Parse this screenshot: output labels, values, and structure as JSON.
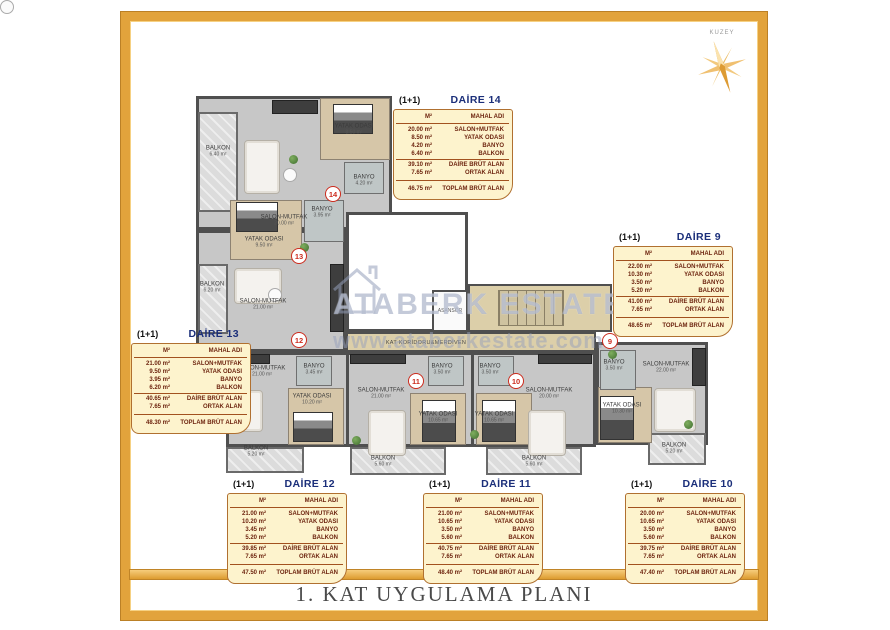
{
  "page": {
    "title": "1. KAT UYGULAMA PLANI"
  },
  "compass": {
    "label": "KUZEY"
  },
  "watermark": {
    "text": "ATABERK ESTATE",
    "url": "www.ataberkestate.com"
  },
  "colors": {
    "frame_gold": "#e2a33c",
    "table_bg": "#fdf3cd",
    "table_border": "#b07030",
    "table_text": "#6e2510",
    "unit_name_navy": "#1b2f7a",
    "badge_red": "#cc2b1d",
    "corridor_beige": "#dccfa9",
    "watermark_blue": "#949eba"
  },
  "tables": [
    {
      "type": "(1+1)",
      "name": "DAİRE 14",
      "col_area": "M²",
      "col_room": "MAHAL ADI",
      "rows": [
        [
          "20.00 m²",
          "SALON+MUTFAK"
        ],
        [
          "8.50 m²",
          "YATAK ODASI"
        ],
        [
          "4.20 m²",
          "BANYO"
        ],
        [
          "6.40 m²",
          "BALKON"
        ]
      ],
      "sub": [
        [
          "39.10 m²",
          "DAİRE BRÜT ALAN"
        ],
        [
          "7.65 m²",
          "ORTAK ALAN"
        ]
      ],
      "total": [
        "46.75 m²",
        "TOPLAM BRÜT ALAN"
      ]
    },
    {
      "type": "(1+1)",
      "name": "DAİRE 9",
      "col_area": "M²",
      "col_room": "MAHAL ADI",
      "rows": [
        [
          "22.00 m²",
          "SALON+MUTFAK"
        ],
        [
          "10.30 m²",
          "YATAK ODASI"
        ],
        [
          "3.50 m²",
          "BANYO"
        ],
        [
          "5.20 m²",
          "BALKON"
        ]
      ],
      "sub": [
        [
          "41.00 m²",
          "DAİRE BRÜT ALAN"
        ],
        [
          "7.65 m²",
          "ORTAK ALAN"
        ]
      ],
      "total": [
        "48.65 m²",
        "TOPLAM BRÜT ALAN"
      ]
    },
    {
      "type": "(1+1)",
      "name": "DAİRE 13",
      "col_area": "M²",
      "col_room": "MAHAL ADI",
      "rows": [
        [
          "21.00 m²",
          "SALON+MUTFAK"
        ],
        [
          "9.50 m²",
          "YATAK ODASI"
        ],
        [
          "3.95 m²",
          "BANYO"
        ],
        [
          "6.20 m²",
          "BALKON"
        ]
      ],
      "sub": [
        [
          "40.65 m²",
          "DAİRE BRÜT ALAN"
        ],
        [
          "7.65 m²",
          "ORTAK ALAN"
        ]
      ],
      "total": [
        "48.30 m²",
        "TOPLAM BRÜT ALAN"
      ]
    },
    {
      "type": "(1+1)",
      "name": "DAİRE 12",
      "col_area": "M²",
      "col_room": "MAHAL ADI",
      "rows": [
        [
          "21.00 m²",
          "SALON+MUTFAK"
        ],
        [
          "10.20 m²",
          "YATAK ODASI"
        ],
        [
          "3.45 m²",
          "BANYO"
        ],
        [
          "5.20 m²",
          "BALKON"
        ]
      ],
      "sub": [
        [
          "39.85 m²",
          "DAİRE BRÜT ALAN"
        ],
        [
          "7.65 m²",
          "ORTAK ALAN"
        ]
      ],
      "total": [
        "47.50 m²",
        "TOPLAM BRÜT ALAN"
      ]
    },
    {
      "type": "(1+1)",
      "name": "DAİRE 11",
      "col_area": "M²",
      "col_room": "MAHAL ADI",
      "rows": [
        [
          "21.00 m²",
          "SALON+MUTFAK"
        ],
        [
          "10.65 m²",
          "YATAK ODASI"
        ],
        [
          "3.50 m²",
          "BANYO"
        ],
        [
          "5.60 m²",
          "BALKON"
        ]
      ],
      "sub": [
        [
          "40.75 m²",
          "DAİRE BRÜT ALAN"
        ],
        [
          "7.65 m²",
          "ORTAK ALAN"
        ]
      ],
      "total": [
        "48.40 m²",
        "TOPLAM BRÜT ALAN"
      ]
    },
    {
      "type": "(1+1)",
      "name": "DAİRE 10",
      "col_area": "M²",
      "col_room": "MAHAL ADI",
      "rows": [
        [
          "20.00 m²",
          "SALON+MUTFAK"
        ],
        [
          "10.65 m²",
          "YATAK ODASI"
        ],
        [
          "3.50 m²",
          "BANYO"
        ],
        [
          "5.60 m²",
          "BALKON"
        ]
      ],
      "sub": [
        [
          "39.75 m²",
          "DAİRE BRÜT ALAN"
        ],
        [
          "7.65 m²",
          "ORTAK ALAN"
        ]
      ],
      "total": [
        "47.40 m²",
        "TOPLAM BRÜT ALAN"
      ]
    }
  ],
  "plan": {
    "corridor_label": "KAT KORİDORU&MERDİVEN",
    "elevator_label": "ASANSÖR",
    "units": [
      {
        "no": "14",
        "rooms": {
          "salon": {
            "label": "SALON-MUTFAK",
            "area": "20.00 m²"
          },
          "yatak": {
            "label": "YATAK ODASI",
            "area": "8.50 m²"
          },
          "banyo": {
            "label": "BANYO",
            "area": "4.20 m²"
          },
          "balkon": {
            "label": "BALKON",
            "area": "6.40 m²"
          }
        }
      },
      {
        "no": "13",
        "rooms": {
          "salon": {
            "label": "SALON-MUTFAK",
            "area": "21.00 m²"
          },
          "yatak": {
            "label": "YATAK ODASI",
            "area": "9.50 m²"
          },
          "banyo": {
            "label": "BANYO",
            "area": "3.95 m²"
          },
          "balkon": {
            "label": "BALKON",
            "area": "6.20 m²"
          }
        }
      },
      {
        "no": "12",
        "rooms": {
          "salon": {
            "label": "SALON-MUTFAK",
            "area": "21.00 m²"
          },
          "yatak": {
            "label": "YATAK ODASI",
            "area": "10.20 m²"
          },
          "banyo": {
            "label": "BANYO",
            "area": "3.45 m²"
          },
          "balkon": {
            "label": "BALKON",
            "area": "5.20 m²"
          }
        }
      },
      {
        "no": "11",
        "rooms": {
          "salon": {
            "label": "SALON-MUTFAK",
            "area": "21.00 m²"
          },
          "yatak": {
            "label": "YATAK ODASI",
            "area": "10.65 m²"
          },
          "banyo": {
            "label": "BANYO",
            "area": "3.50 m²"
          },
          "balkon": {
            "label": "BALKON",
            "area": "5.60 m²"
          }
        }
      },
      {
        "no": "10",
        "rooms": {
          "salon": {
            "label": "SALON-MUTFAK",
            "area": "20.00 m²"
          },
          "yatak": {
            "label": "YATAK ODASI",
            "area": "10.65 m²"
          },
          "banyo": {
            "label": "BANYO",
            "area": "3.50 m²"
          },
          "balkon": {
            "label": "BALKON",
            "area": "5.60 m²"
          }
        }
      },
      {
        "no": "9",
        "rooms": {
          "salon": {
            "label": "SALON-MUTFAK",
            "area": "22.00 m²"
          },
          "yatak": {
            "label": "YATAK ODASI",
            "area": "10.30 m²"
          },
          "banyo": {
            "label": "BANYO",
            "area": "3.50 m²"
          },
          "balkon": {
            "label": "BALKON",
            "area": "5.20 m²"
          }
        }
      }
    ]
  }
}
